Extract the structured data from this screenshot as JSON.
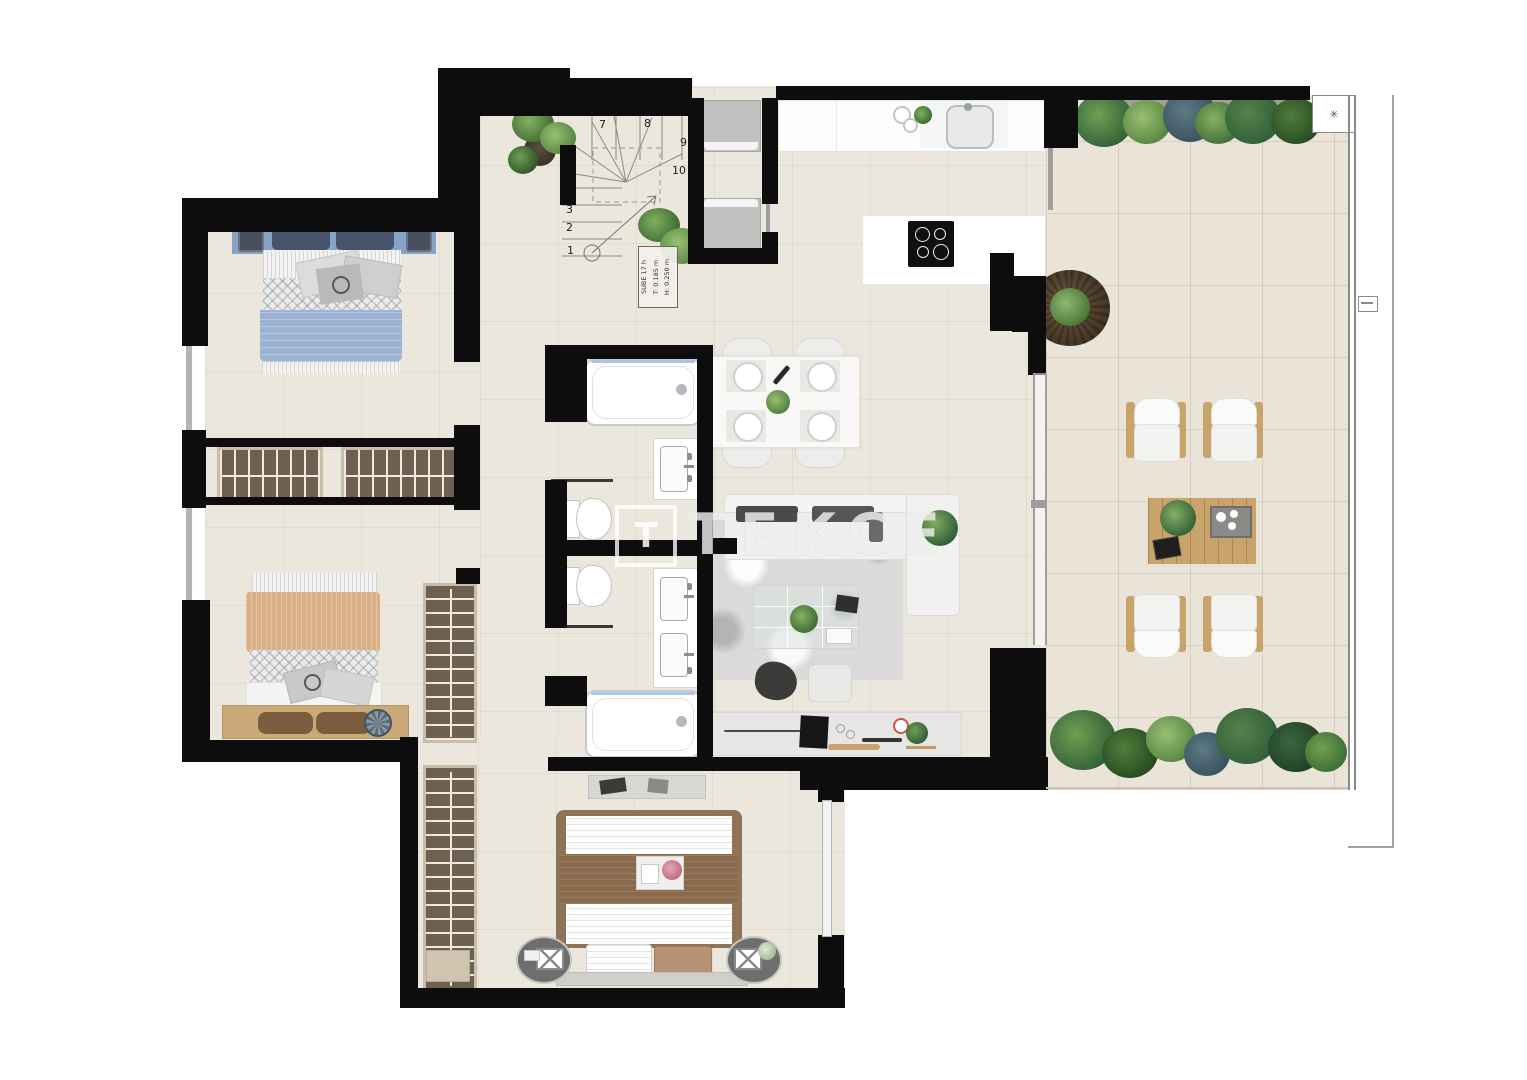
{
  "watermark": {
    "logo_letter": "T",
    "text": "TEKCE"
  },
  "stairs": {
    "steps": [
      "1",
      "2",
      "3",
      "4",
      "5",
      "6",
      "7",
      "8",
      "9",
      "10"
    ],
    "label_lines": [
      "SUBE 17 h",
      "T: 0.185 m",
      "H: 0.250 m"
    ]
  },
  "terrace": {
    "corner_icon_glyph": "✳"
  },
  "palette": {
    "wall": "#0d0d0d",
    "floor": "#ece7dd",
    "terrace_floor": "#eae4d8",
    "wood": "#c8a36a",
    "wardrobe": "#6e6050",
    "plant_dark": "#2f5d38",
    "plant_mid": "#55824a",
    "plant_light": "#7fae5e",
    "bed_blue": "#9cb3d3",
    "bed_tan": "#d9b185",
    "bed_brown": "#8a6b4d",
    "rug": "#dadad8",
    "watermark": "rgba(255,255,255,0.72)"
  }
}
